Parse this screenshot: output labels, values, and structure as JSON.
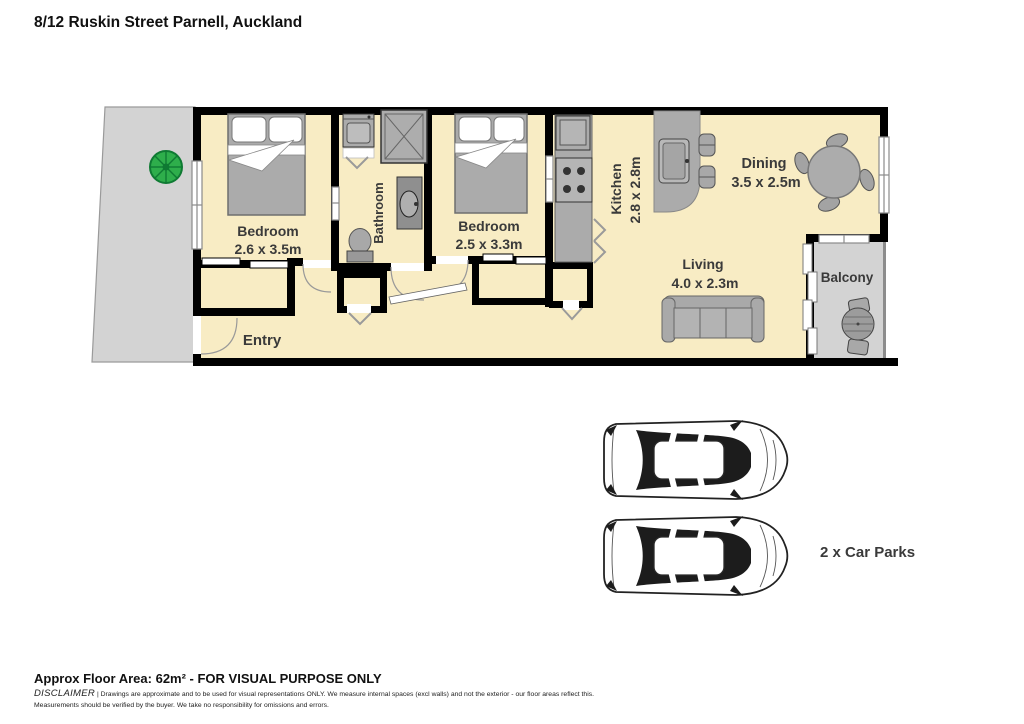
{
  "title": "8/12 Ruskin Street Parnell, Auckland",
  "plan": {
    "bedroom1": {
      "name": "Bedroom",
      "dims": "2.6 x 3.5m"
    },
    "bathroom": {
      "name": "Bathroom"
    },
    "bedroom2": {
      "name": "Bedroom",
      "dims": "2.5 x 3.3m"
    },
    "kitchen": {
      "name": "Kitchen",
      "dims": "2.8 x 2.8m"
    },
    "dining": {
      "name": "Dining",
      "dims": "3.5 x 2.5m"
    },
    "living": {
      "name": "Living",
      "dims": "4.0 x 2.3m"
    },
    "balcony": {
      "name": "Balcony"
    },
    "entry": {
      "name": "Entry"
    }
  },
  "carpark": {
    "label": "2 x Car Parks",
    "count": 2
  },
  "footer": {
    "area": "Approx Floor Area: 62m² - FOR VISUAL PURPOSE ONLY",
    "disclaimer_word": "DISCLAIMER",
    "disclaimer_rest": "| Drawings are approximate and to be used for visual representations ONLY. We measure internal spaces (excl walls) and not the exterior - our floor areas reflect this.",
    "disclaimer_line2": "Measurements should be verified by the buyer. We take no responsibility for omissions and errors."
  },
  "colors": {
    "floor": "#F8ECC4",
    "outdoor": "#D3D3D3",
    "wall": "#000000",
    "furniture": "#ABABAB",
    "tree_green": "#2EAE4B",
    "label_text": "#3A3A3A"
  }
}
